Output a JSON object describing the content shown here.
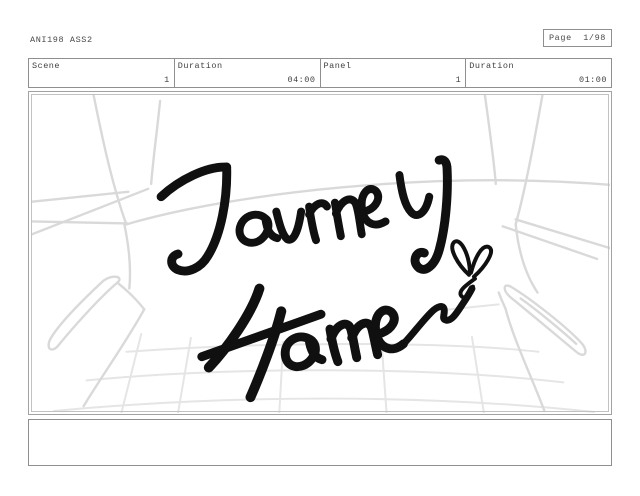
{
  "document": {
    "production_code": "ANI198 ASS2",
    "page_indicator": "Page  1/98"
  },
  "meta_table": {
    "cells": [
      {
        "label": "Scene",
        "value": "1"
      },
      {
        "label": "Duration",
        "value": "04:00"
      },
      {
        "label": "Panel",
        "value": "1"
      },
      {
        "label": "Duration",
        "value": "01:00"
      }
    ]
  },
  "storyboard_panel": {
    "drawing_text": "Journey Home~",
    "drawing_text_line1": "Journey",
    "drawing_text_line2": "Home~",
    "drawing_elements": "hand-lettered title with butterfly doodle over light pencil sketch of interior with quilted grid",
    "ink_color": "#101010",
    "sketch_color": "#d9d9d9",
    "grid_color": "#e5e5e5"
  },
  "notes_box": {
    "text": ""
  }
}
